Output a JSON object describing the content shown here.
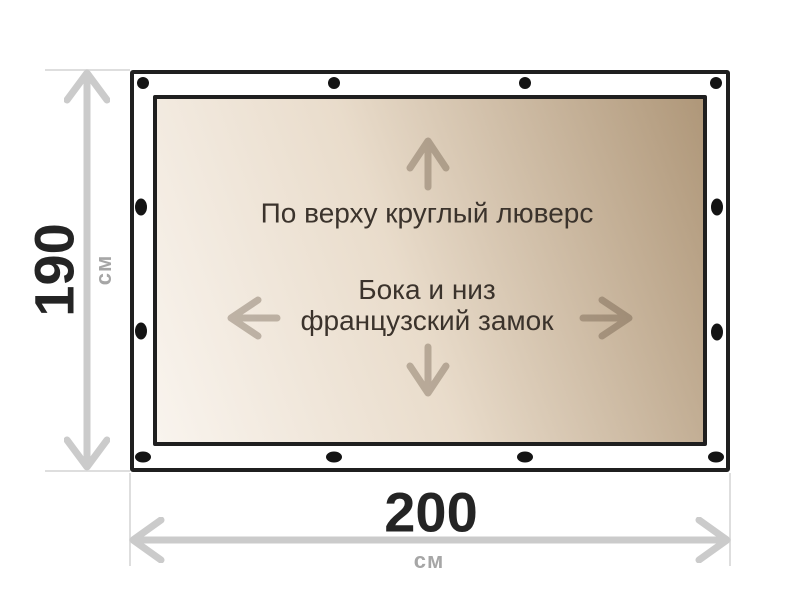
{
  "diagram": {
    "title": "tarp-dimensions-diagram",
    "top_note": "По верху круглый люверс",
    "middle_note_line1": "Бока и низ",
    "middle_note_line2": "французский замок"
  },
  "dimensions": {
    "height": {
      "value": "190",
      "unit": "см"
    },
    "width": {
      "value": "200",
      "unit": "см"
    }
  },
  "grommets": {
    "top": 4,
    "bottom": 4,
    "left": 2,
    "right": 2
  },
  "icons": [
    "up-arrow-icon",
    "down-arrow-icon",
    "left-arrow-icon",
    "right-arrow-icon",
    "height-dimension-arrow-icon",
    "width-dimension-arrow-icon"
  ],
  "colors": {
    "background": "#ffffff",
    "tarp_border": "#1f1f1f",
    "tarp_margin": "#ffffff",
    "tarp_gradient_light": "#f9f4ee",
    "tarp_gradient_dark": "#af9779",
    "grommet": "#141414",
    "note_text": "#3b332c",
    "inner_arrow": "rgba(82,64,45,0.33)",
    "dimension_line": "#cbcbcb",
    "extension_line": "#dedede",
    "dimension_value_text": "#242424",
    "dimension_unit_text": "#a6a6a6"
  }
}
